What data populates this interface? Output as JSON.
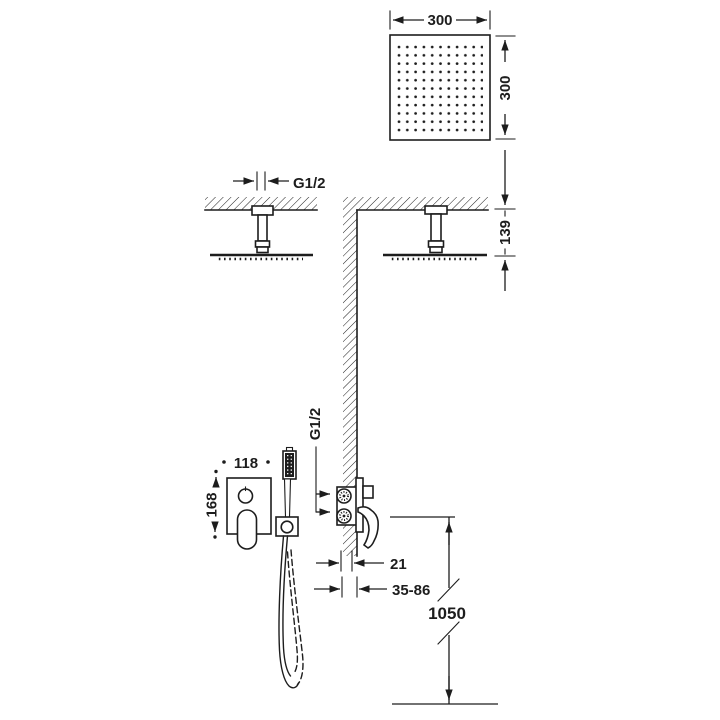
{
  "colors": {
    "line": "#1d1d1d",
    "bg": "#ffffff"
  },
  "labels": {
    "head_width": "300",
    "head_depth": "300",
    "ceiling_thread": "G1/2",
    "ceiling_drop": "139",
    "inlet_thread": "G1/2",
    "plate_width": "118",
    "plate_height": "168",
    "wall_min": "21",
    "wall_range": "35-86",
    "hose_length": "1050"
  }
}
